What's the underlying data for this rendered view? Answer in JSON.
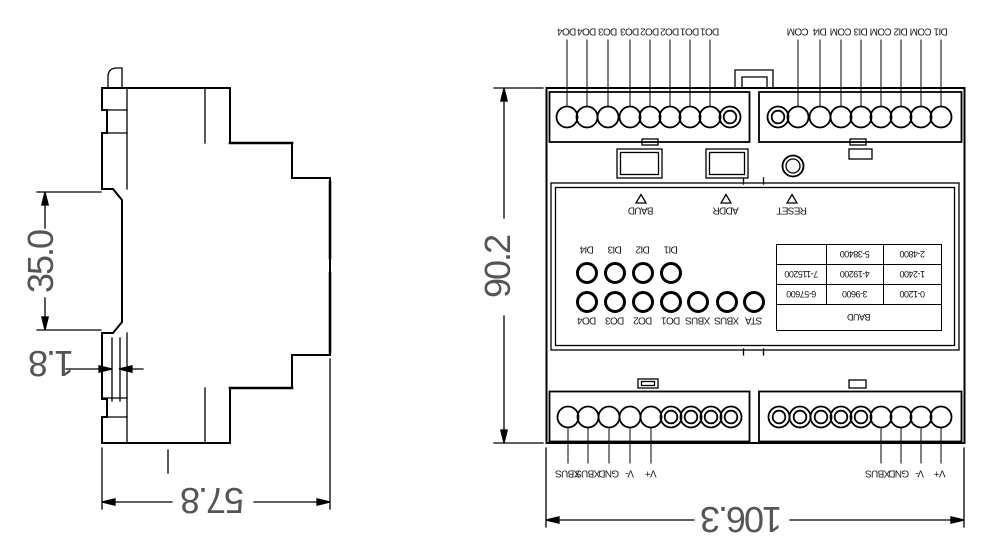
{
  "colors": {
    "line": "#000000",
    "background": "#ffffff"
  },
  "side_view": {
    "dims": {
      "height": "35.0",
      "clip_gap": "1.8",
      "depth": "57.8"
    }
  },
  "front_view": {
    "dims": {
      "height": "90.2",
      "width": "106.3"
    },
    "top_left_terminals": [
      "DO4",
      "DO4",
      "DO3",
      "DO3",
      "DO2",
      "DO2",
      "DO1",
      "DO1"
    ],
    "top_right_terminals": [
      "COM",
      "DI4",
      "COM",
      "DI3",
      "COM",
      "DI2",
      "COM",
      "DI1"
    ],
    "bottom_left_terminals": [
      "XBUS",
      "XBUS",
      "GND",
      "V-",
      "V+"
    ],
    "bottom_right_terminals": [
      "XBUS",
      "GND",
      "V-",
      "V+"
    ],
    "controls": [
      "BAUD",
      "ADDR",
      "RESET"
    ],
    "led_labels_top": [
      "DI4",
      "DI3",
      "DI2",
      "DI1"
    ],
    "led_labels_bottom": [
      "DO4",
      "DO3",
      "DO2",
      "DO1",
      "XBUS",
      "XBUS",
      "STA"
    ],
    "baud_table": {
      "header": "BAUD",
      "rows": [
        [
          "0-1200",
          "3-9600",
          "6-57600"
        ],
        [
          "1-2400",
          "4-19200",
          "7-115200"
        ],
        [
          "2-4800",
          "5-38400",
          ""
        ]
      ]
    }
  }
}
